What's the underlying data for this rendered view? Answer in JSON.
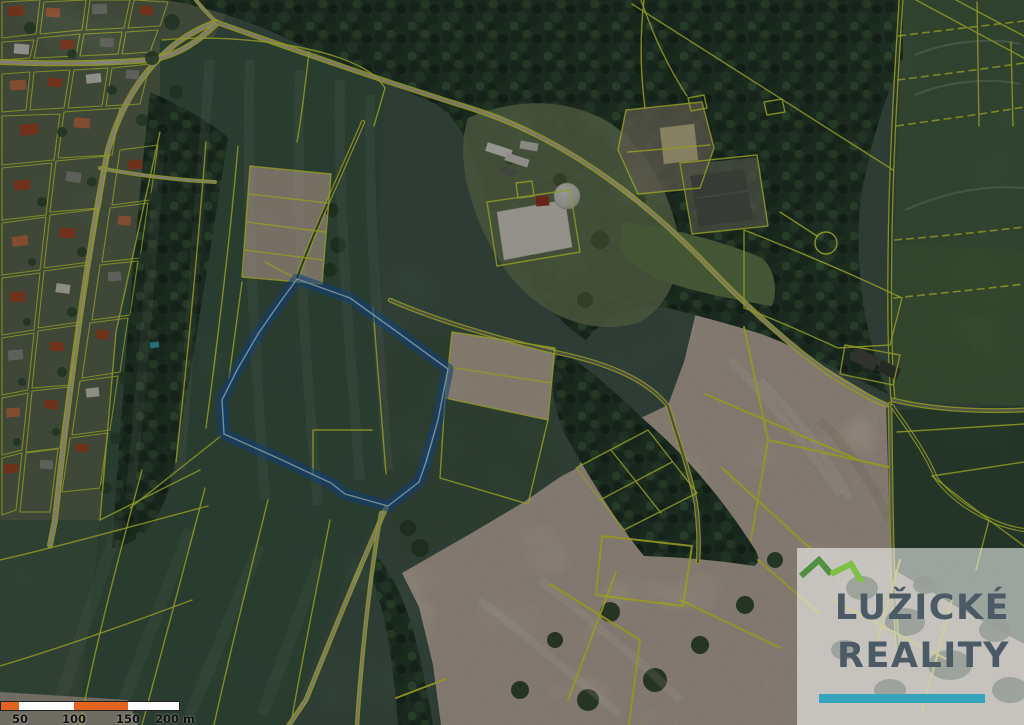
{
  "app": {
    "type": "real-estate-aerial-cadastral-map"
  },
  "map": {
    "description": "Aerial photo with yellow cadastral parcel boundaries and one parcel highlighted in blue",
    "highlighted_parcel": {
      "present": true,
      "outline_color": "#1a66c4"
    }
  },
  "scale_bar": {
    "labels": [
      "50",
      "100",
      "150",
      "200 m"
    ]
  },
  "watermark": {
    "line1": "LUŽICKÉ",
    "line2": "REALITY"
  },
  "colors": {
    "parcel_line": "#e9f63b",
    "parcel_line_bright": "#f2f233",
    "highlight_stroke": "#1a66c4",
    "highlight_inner": "#c2e9f6",
    "scale_orange": "#e2641f",
    "scale_white": "#ffffff",
    "scale_text": "#111111",
    "watermark_text": "#4b5a64",
    "watermark_bar": "#36a3bd",
    "watermark_panel": "rgba(255,255,255,0.55)",
    "logo_dark": "#4f9140",
    "logo_light": "#7cc142",
    "field_green": "#4b6355",
    "forest_green": "#2d4434",
    "soil_beige": "#cfc2b2",
    "road_dirt": "#c9bfa8"
  }
}
